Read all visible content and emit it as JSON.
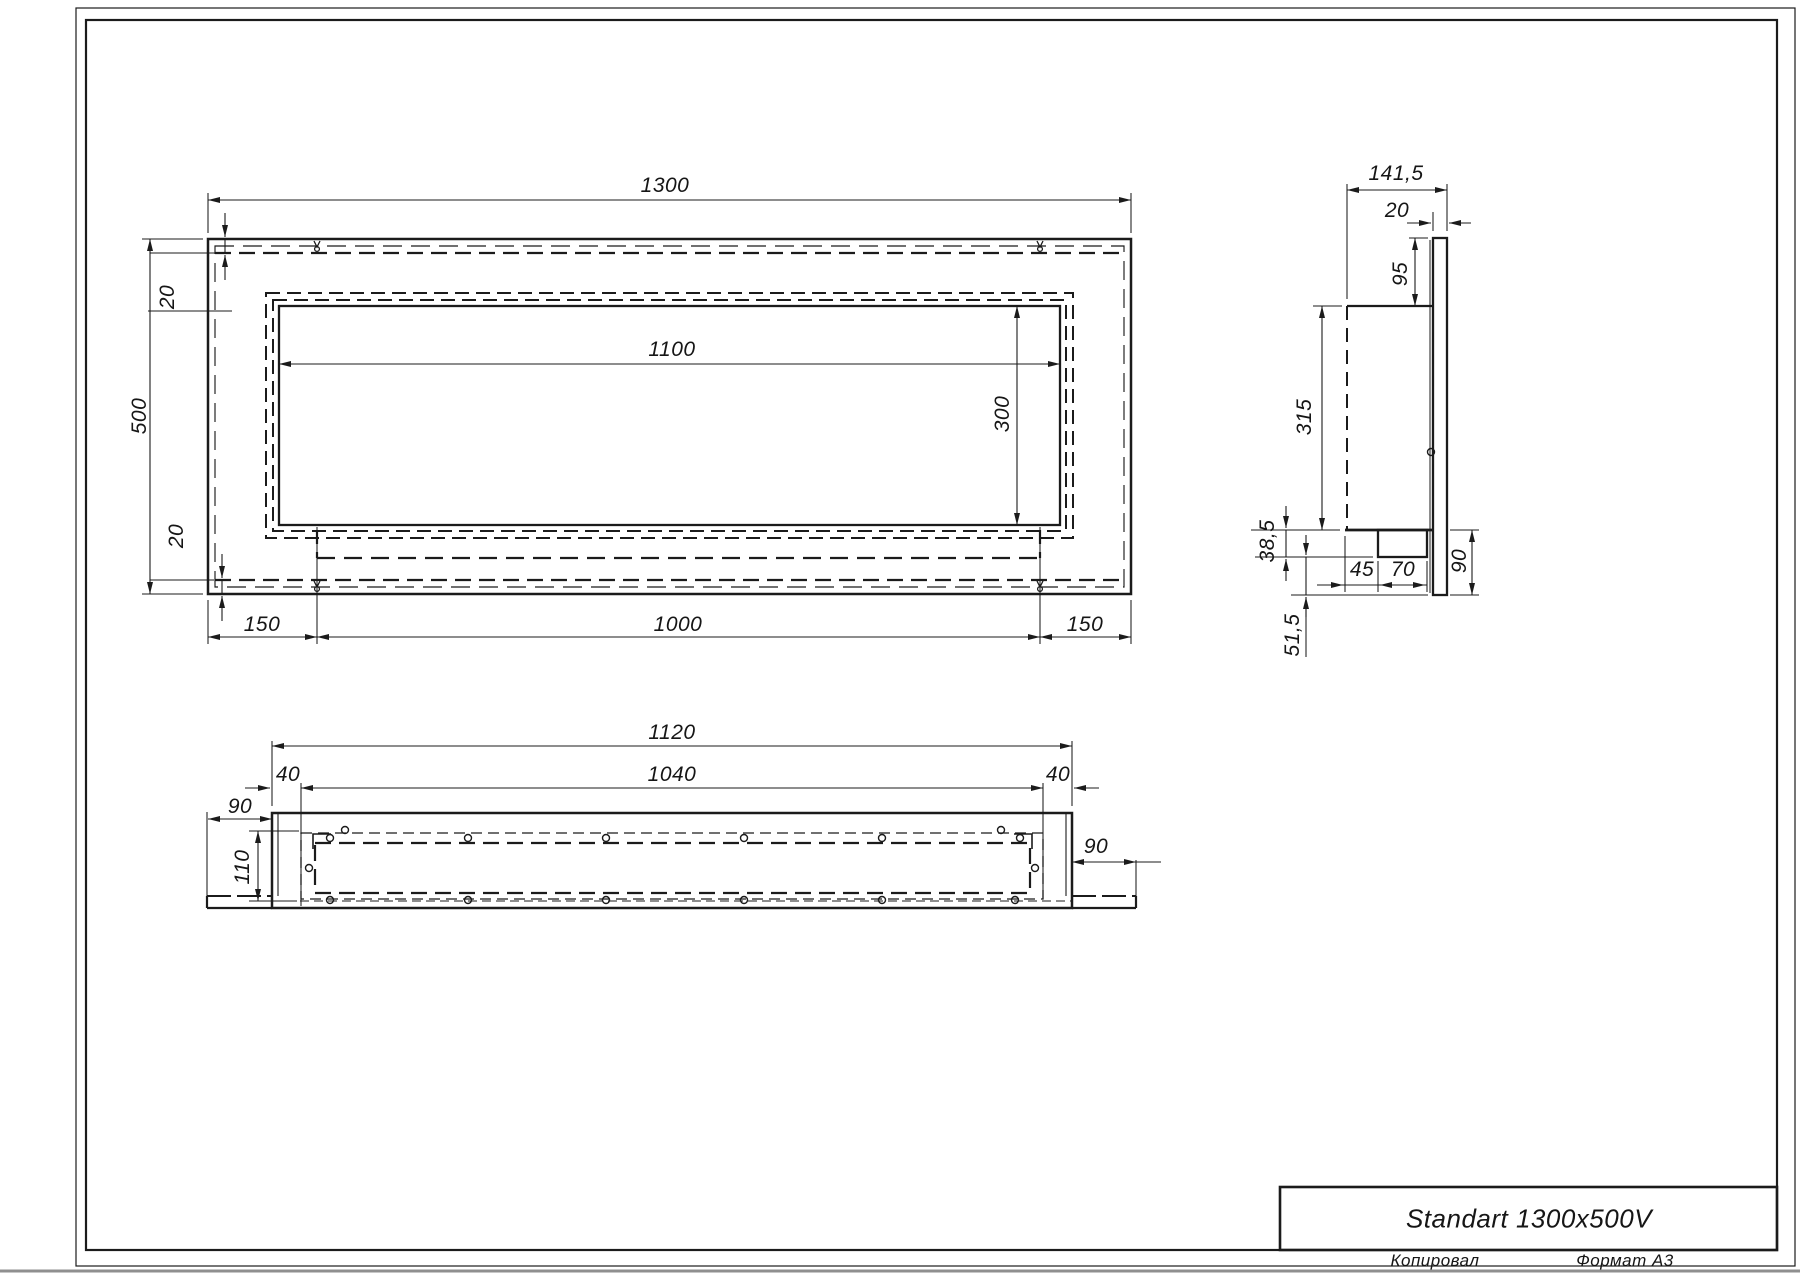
{
  "title_block": {
    "product_name": "Standart 1300x500V",
    "copied_label": "Копировал",
    "format_label": "Формат А3"
  },
  "drawing": {
    "line_color": "#1b1b1b",
    "views": [
      "front view",
      "side section",
      "bottom view"
    ]
  },
  "dims": {
    "front": {
      "overall_width": "1300",
      "overall_height": "500",
      "opening_width": "1100",
      "opening_height": "300",
      "margin_top": "20",
      "margin_bottom": "20",
      "offset_left": "150",
      "span_center": "1000",
      "offset_right": "150"
    },
    "side": {
      "overall_depth": "141,5",
      "panel_thickness": "20",
      "top_drop": "95",
      "body_height": "315",
      "tray_height": "38,5",
      "tray_offset": "45",
      "tray_width": "70",
      "panel_below_body": "90",
      "bottom_gap": "51,5"
    },
    "plan": {
      "body_width": "1120",
      "inner_width": "1040",
      "inset_left": "40",
      "inset_right": "40",
      "panel_ext_left": "90",
      "inner_depth": "110",
      "panel_ext_right": "90"
    }
  }
}
